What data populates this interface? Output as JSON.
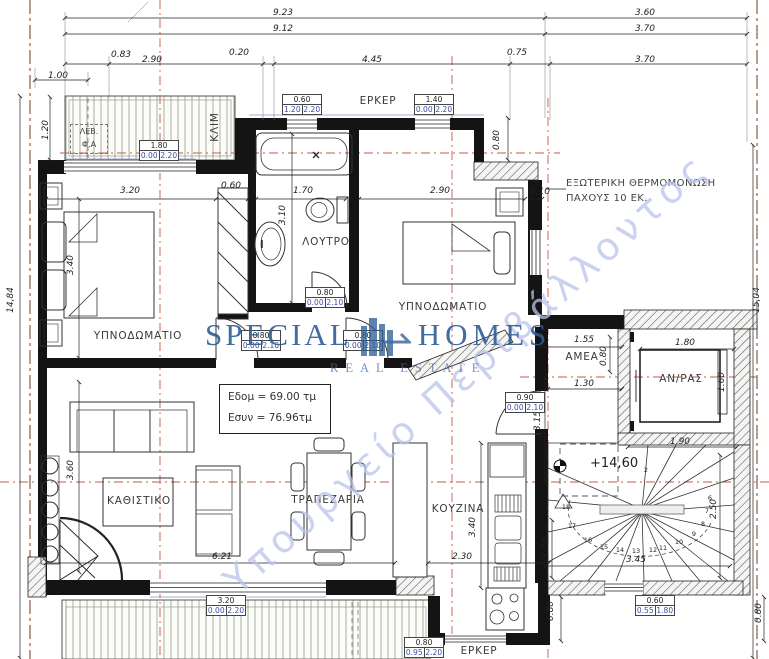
{
  "plan": {
    "rooms": [
      {
        "name": "room-label-bedroom-left",
        "label": "ΥΠΝΟΔΩΜΑΤΙΟ",
        "x": 138,
        "y": 336
      },
      {
        "name": "room-label-bathroom",
        "label": "ΛΟΥΤΡΟ",
        "x": 326,
        "y": 242
      },
      {
        "name": "room-label-bedroom-right",
        "label": "ΥΠΝΟΔΩΜΑΤΙΟ",
        "x": 443,
        "y": 307
      },
      {
        "name": "room-label-living",
        "label": "ΚΑΘΙΣΤΙΚΟ",
        "x": 139,
        "y": 501
      },
      {
        "name": "room-label-dining",
        "label": "ΤΡΑΠΕΖΑΡΙΑ",
        "x": 328,
        "y": 500
      },
      {
        "name": "room-label-kitchen",
        "label": "ΚΟΥΖΙΝΑ",
        "x": 458,
        "y": 509
      },
      {
        "name": "room-label-amea",
        "label": "ΑΜΕΑ",
        "x": 582,
        "y": 357
      },
      {
        "name": "room-label-elevator",
        "label": "ΑΝ/ΡΑΣ",
        "x": 681,
        "y": 379
      },
      {
        "name": "label-erker-top",
        "label": "ΕΡΚΕΡ",
        "x": 378,
        "y": 101
      },
      {
        "name": "label-erker-bottom",
        "label": "ΕΡΚΕΡ",
        "x": 479,
        "y": 651
      },
      {
        "name": "label-klim",
        "label": "ΚΛΙΜ",
        "x": 215,
        "y": 127,
        "rot": -90
      }
    ],
    "dimensions": [
      {
        "text": "9.23",
        "x": 283,
        "y": 13
      },
      {
        "text": "3.60",
        "x": 645,
        "y": 13
      },
      {
        "text": "9.12",
        "x": 283,
        "y": 29
      },
      {
        "text": "3.70",
        "x": 645,
        "y": 29
      },
      {
        "text": "0.83",
        "x": 121,
        "y": 55
      },
      {
        "text": "2.90",
        "x": 152,
        "y": 60
      },
      {
        "text": "0.20",
        "x": 239,
        "y": 53
      },
      {
        "text": "4.45",
        "x": 372,
        "y": 60
      },
      {
        "text": "0.75",
        "x": 517,
        "y": 53
      },
      {
        "text": "3.70",
        "x": 645,
        "y": 60
      },
      {
        "text": "1.00",
        "x": 58,
        "y": 76
      },
      {
        "text": "1.20",
        "x": 46,
        "y": 130,
        "rot": -90
      },
      {
        "text": "14,84",
        "x": 11,
        "y": 300,
        "rot": -90
      },
      {
        "text": "15,04",
        "x": 757,
        "y": 300,
        "rot": -90
      },
      {
        "text": "3.20",
        "x": 130,
        "y": 191
      },
      {
        "text": "0.60",
        "x": 231,
        "y": 186
      },
      {
        "text": "1.70",
        "x": 303,
        "y": 191
      },
      {
        "text": "2.90",
        "x": 440,
        "y": 191
      },
      {
        "text": "0.10",
        "x": 540,
        "y": 192
      },
      {
        "text": "0.80",
        "x": 497,
        "y": 140,
        "rot": -90
      },
      {
        "text": "3.40",
        "x": 71,
        "y": 265,
        "rot": -90
      },
      {
        "text": "3.10",
        "x": 283,
        "y": 215,
        "rot": -90
      },
      {
        "text": "3.60",
        "x": 71,
        "y": 470,
        "rot": -90
      },
      {
        "text": "6.21",
        "x": 222,
        "y": 557
      },
      {
        "text": "2.30",
        "x": 462,
        "y": 557
      },
      {
        "text": "3.40",
        "x": 473,
        "y": 527,
        "rot": -90
      },
      {
        "text": "3.15",
        "x": 538,
        "y": 421,
        "rot": -90
      },
      {
        "text": "1.55",
        "x": 584,
        "y": 340
      },
      {
        "text": "0.80",
        "x": 604,
        "y": 356,
        "rot": -90
      },
      {
        "text": "1.30",
        "x": 584,
        "y": 384
      },
      {
        "text": "1.80",
        "x": 685,
        "y": 343
      },
      {
        "text": "1.60",
        "x": 722,
        "y": 382,
        "rot": -90
      },
      {
        "text": "1.90",
        "x": 680,
        "y": 442
      },
      {
        "text": "2.50",
        "x": 714,
        "y": 509,
        "rot": -90
      },
      {
        "text": "3.45",
        "x": 636,
        "y": 560
      },
      {
        "text": "1.20",
        "x": 546,
        "y": 548,
        "rot": -90
      },
      {
        "text": "0.80",
        "x": 551,
        "y": 611,
        "rot": -90
      },
      {
        "text": "0.80",
        "x": 759,
        "y": 613,
        "rot": -90
      }
    ],
    "spec_boxes": [
      {
        "w": "1.80",
        "s": "0.00",
        "h": "2.20",
        "x": 139,
        "y": 140
      },
      {
        "w": "0.60",
        "s": "1.20",
        "h": "2.20",
        "x": 282,
        "y": 94
      },
      {
        "w": "1.40",
        "s": "0.00",
        "h": "2.20",
        "x": 414,
        "y": 94
      },
      {
        "w": "0.80",
        "s": "0.00",
        "h": "2.10",
        "x": 241,
        "y": 330
      },
      {
        "w": "0.80",
        "s": "0.00",
        "h": "2.10",
        "x": 305,
        "y": 287
      },
      {
        "w": "0.80",
        "s": "0.00",
        "h": "2.10",
        "x": 343,
        "y": 330
      },
      {
        "w": "0.90",
        "s": "0.00",
        "h": "2.10",
        "x": 505,
        "y": 392
      },
      {
        "w": "3.20",
        "s": "0.00",
        "h": "2.20",
        "x": 206,
        "y": 595
      },
      {
        "w": "0.80",
        "s": "0.95",
        "h": "2.20",
        "x": 404,
        "y": 637
      },
      {
        "w": "0.60",
        "s": "0.55",
        "h": "1.80",
        "x": 635,
        "y": 595
      }
    ],
    "stairs": {
      "numbers": [
        {
          "n": "2",
          "x": 646,
          "y": 470
        },
        {
          "n": "18",
          "x": 566,
          "y": 507
        },
        {
          "n": "17",
          "x": 572,
          "y": 526
        },
        {
          "n": "16",
          "x": 588,
          "y": 540
        },
        {
          "n": "15",
          "x": 604,
          "y": 547
        },
        {
          "n": "14",
          "x": 620,
          "y": 550
        },
        {
          "n": "13",
          "x": 636,
          "y": 551
        },
        {
          "n": "12",
          "x": 653,
          "y": 550
        },
        {
          "n": "11",
          "x": 663,
          "y": 548
        },
        {
          "n": "10",
          "x": 679,
          "y": 542
        },
        {
          "n": "9",
          "x": 694,
          "y": 534
        },
        {
          "n": "8",
          "x": 703,
          "y": 524
        },
        {
          "n": "7",
          "x": 707,
          "y": 511
        },
        {
          "n": "6",
          "x": 710,
          "y": 498
        }
      ]
    },
    "insulation": {
      "line1": "ΕΞΩΤΕΡΙΚΗ ΘΕΡΜΟΜΟΝΩΣΗ",
      "line2": "ΠΑΧΟΥΣ 10 ΕΚ."
    },
    "area": {
      "line1": "Εδομ = 69.00 τμ",
      "line2": "Εσυν = 76.96τμ"
    },
    "level": {
      "value": "+14,60"
    },
    "lev": {
      "line1": "ΛΕΒ.",
      "line2": "Φ.Α"
    },
    "watermark": {
      "word1": "SPECIAL",
      "word2": "HOMES",
      "sub": "REAL ESTATE",
      "diagonal": "Υπουργείο Περιβάλλοντος"
    },
    "colors": {
      "axis_red": "#c4584a",
      "property_brown": "#8a5a40",
      "spec_blue": "#3b4da0",
      "watermark_blue": "#2d5d95",
      "watermark_light": "#b9c4ea",
      "wall_black": "#141414"
    }
  }
}
